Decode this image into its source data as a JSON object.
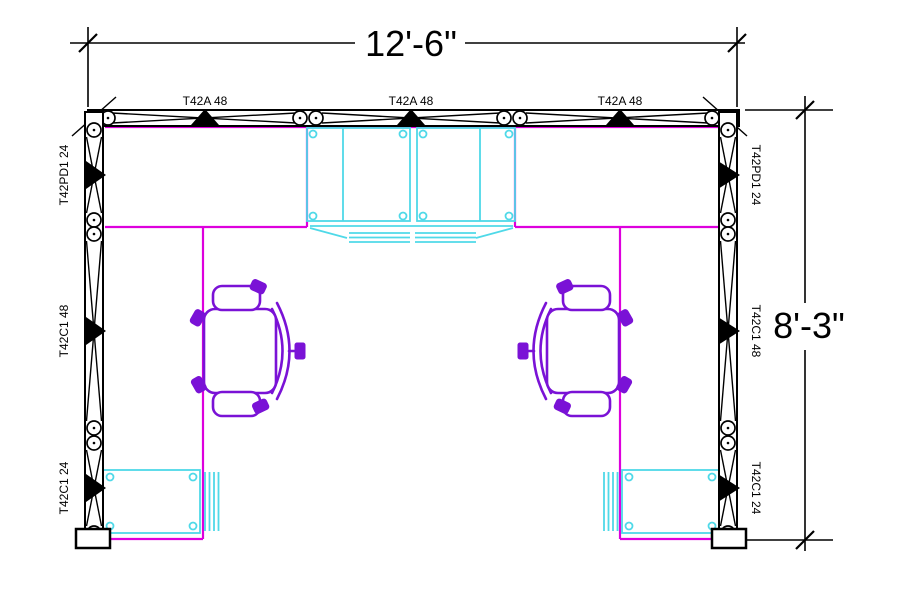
{
  "drawing": {
    "title": "Cubicle workstation floor plan",
    "dimension_width": "12'-6\"",
    "dimension_height": "8'-3\"",
    "panels_top": [
      {
        "label": "T42A 48"
      },
      {
        "label": "T42A 48"
      },
      {
        "label": "T42A 48"
      }
    ],
    "panels_left": [
      {
        "label": "T42PD1 24"
      },
      {
        "label": "T42C1 48"
      },
      {
        "label": "T42C1 24"
      }
    ],
    "panels_right": [
      {
        "label": "T42PD1 24"
      },
      {
        "label": "T42C1 48"
      },
      {
        "label": "T42C1 24"
      }
    ],
    "colors": {
      "panel_line": "#000000",
      "worksurface": "#dd00dd",
      "storage": "#4fd9e8",
      "chair": "#7a12d6",
      "background": "#ffffff"
    }
  }
}
